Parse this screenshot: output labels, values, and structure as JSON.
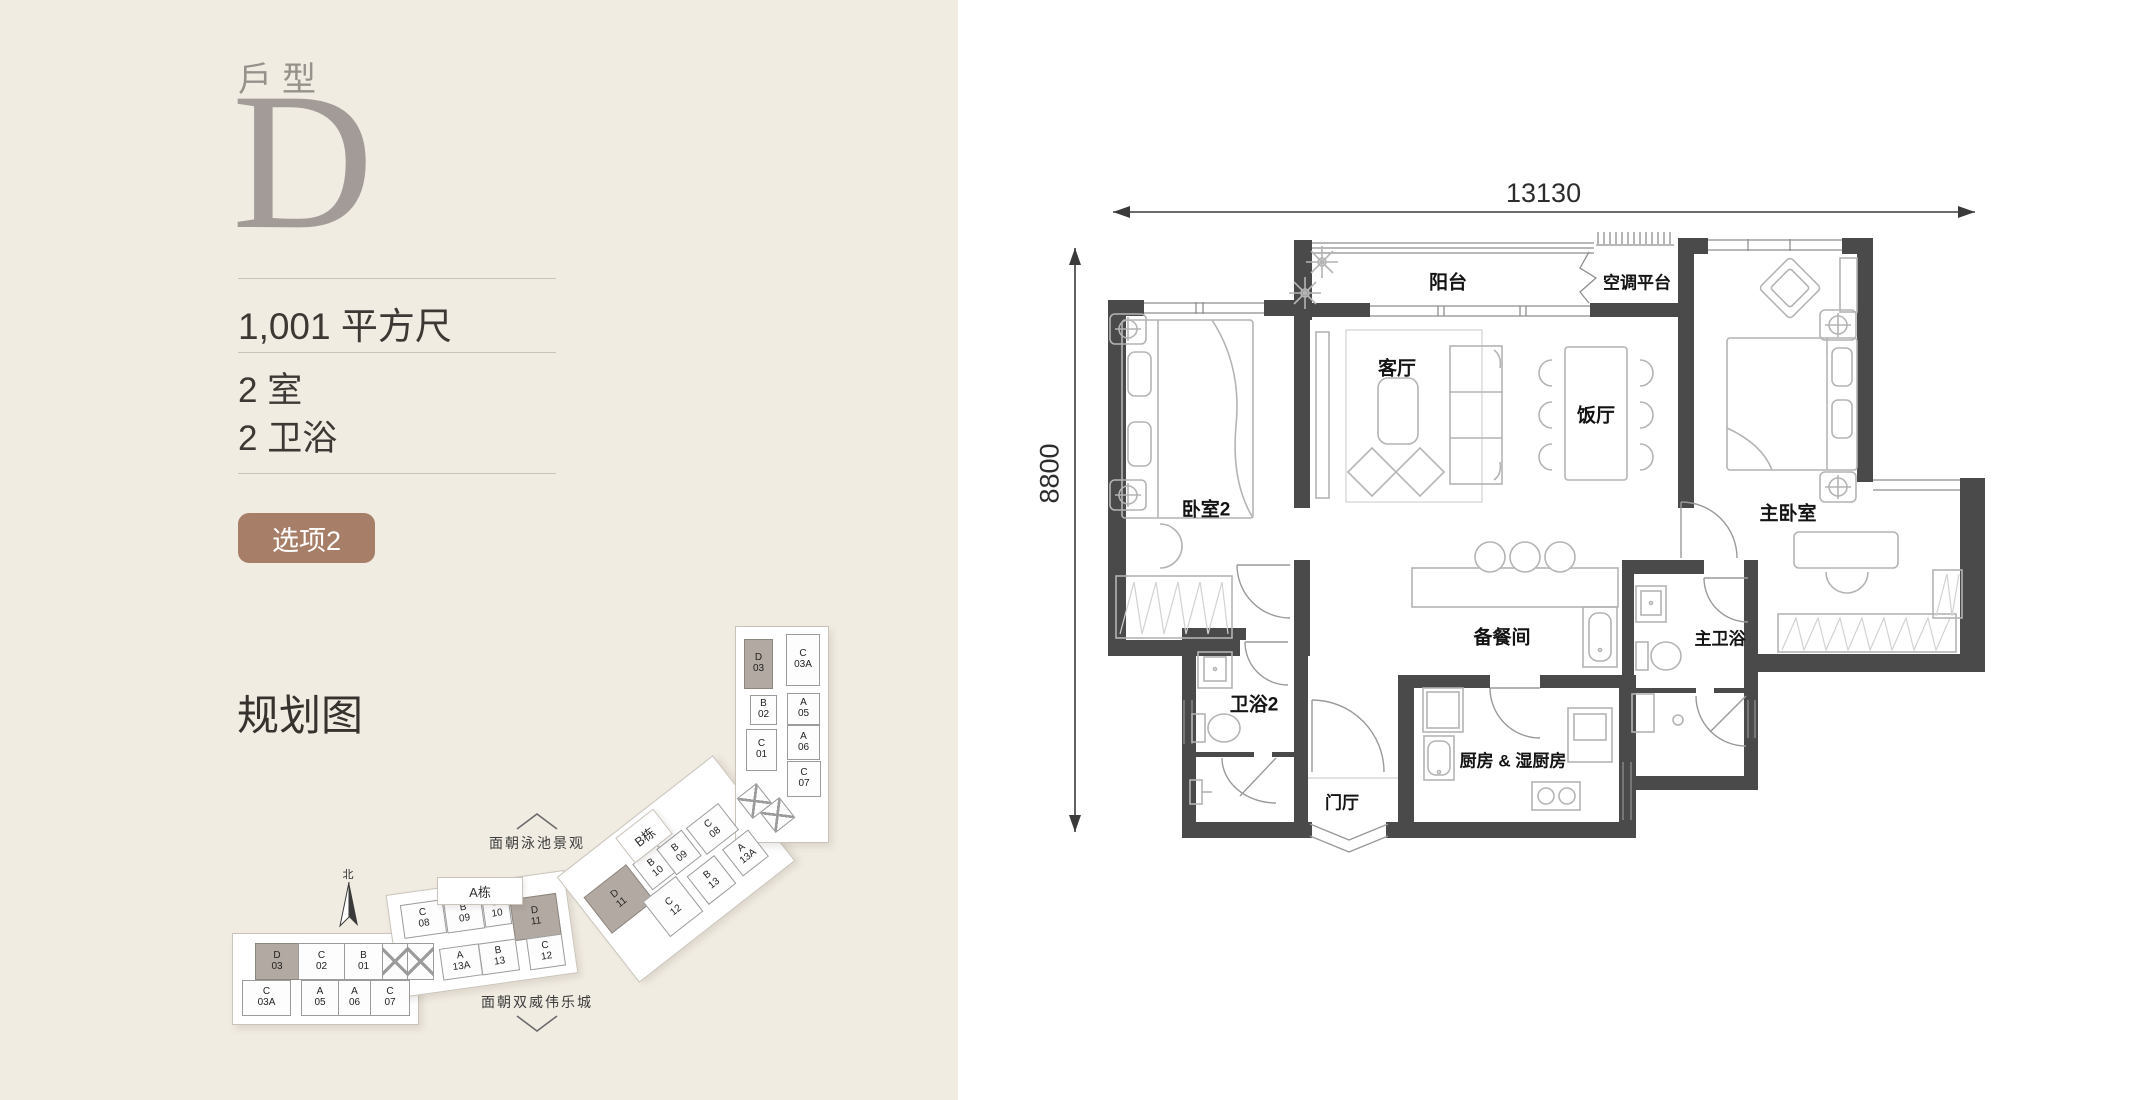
{
  "left_panel": {
    "unit_type_label": "戶型",
    "unit_type": "D",
    "area": "1,001 平方尺",
    "bedrooms": "2 室",
    "bathrooms": "2 卫浴",
    "option_badge": "选项2",
    "site_plan_title": "规划图"
  },
  "theme": {
    "panel_bg": "#f1ece2",
    "badge_bg": "#a77f68",
    "wall_color": "#4a4a4a",
    "unit_highlight": "#b2a9a2"
  },
  "site_plan": {
    "north_label": "北",
    "block_a_label": "A栋",
    "block_b_label": "B栋",
    "annotation_top": "面朝泳池景观",
    "annotation_bottom": "面朝双威伟乐城",
    "units": [
      {
        "l1": "D",
        "l2": "03",
        "x": 15,
        "y": 313,
        "w": 42,
        "h": 35,
        "hl": true
      },
      {
        "l1": "C",
        "l2": "02",
        "x": 58,
        "y": 313,
        "w": 45,
        "h": 35
      },
      {
        "l1": "B",
        "l2": "01",
        "x": 104,
        "y": 313,
        "w": 37,
        "h": 35
      },
      {
        "hatch": true,
        "x": 142,
        "y": 313,
        "w": 24,
        "h": 35
      },
      {
        "hatch": true,
        "x": 167,
        "y": 313,
        "w": 25,
        "h": 35
      },
      {
        "l1": "C",
        "l2": "03A",
        "x": 2,
        "y": 350,
        "w": 47,
        "h": 34
      },
      {
        "l1": "A",
        "l2": "05",
        "x": 61,
        "y": 350,
        "w": 36,
        "h": 34
      },
      {
        "l1": "A",
        "l2": "06",
        "x": 98,
        "y": 350,
        "w": 31,
        "h": 34
      },
      {
        "l1": "C",
        "l2": "07",
        "x": 130,
        "y": 350,
        "w": 38,
        "h": 34
      },
      {
        "l1": "C",
        "l2": "08",
        "x": 162,
        "y": 272,
        "w": 41,
        "h": 32,
        "rot": -8
      },
      {
        "l1": "B",
        "l2": "09",
        "x": 205,
        "y": 267,
        "w": 36,
        "h": 32,
        "rot": -8
      },
      {
        "l1": "B",
        "l2": "10",
        "x": 243,
        "y": 262,
        "w": 25,
        "h": 32,
        "rot": -8
      },
      {
        "l1": "D",
        "l2": "11",
        "x": 272,
        "y": 266,
        "w": 45,
        "h": 40,
        "rot": -8,
        "hl": true
      },
      {
        "l1": "A",
        "l2": "13A",
        "x": 201,
        "y": 316,
        "w": 38,
        "h": 30,
        "rot": -8
      },
      {
        "l1": "B",
        "l2": "13",
        "x": 240,
        "y": 311,
        "w": 36,
        "h": 30,
        "rot": -8
      },
      {
        "l1": "C",
        "l2": "12",
        "x": 288,
        "y": 306,
        "w": 34,
        "h": 30,
        "rot": -8
      },
      {
        "l1": "D",
        "l2": "11",
        "x": 352,
        "y": 246,
        "w": 52,
        "h": 44,
        "rot": -38,
        "hl": true
      },
      {
        "l1": "B",
        "l2": "10",
        "x": 399,
        "y": 221,
        "w": 30,
        "h": 31,
        "rot": -38
      },
      {
        "l1": "B",
        "l2": "09",
        "x": 423,
        "y": 206,
        "w": 30,
        "h": 31,
        "rot": -38
      },
      {
        "l1": "C",
        "l2": "08",
        "x": 452,
        "y": 182,
        "w": 39,
        "h": 32,
        "rot": -38
      },
      {
        "l1": "C",
        "l2": "12",
        "x": 412,
        "y": 254,
        "w": 40,
        "h": 43,
        "rot": -38
      },
      {
        "l1": "B",
        "l2": "13",
        "x": 454,
        "y": 232,
        "w": 33,
        "h": 34,
        "rot": -38
      },
      {
        "l1": "A",
        "l2": "13A",
        "x": 489,
        "y": 206,
        "w": 31,
        "h": 32,
        "rot": -38
      },
      {
        "hatch": true,
        "x": 502,
        "y": 158,
        "w": 23,
        "h": 24,
        "rot": -38
      },
      {
        "hatch": true,
        "x": 525,
        "y": 172,
        "w": 23,
        "h": 24,
        "rot": -38
      },
      {
        "l1": "D",
        "l2": "03",
        "x": 504,
        "y": 9,
        "w": 27,
        "h": 48,
        "hl": true
      },
      {
        "l1": "C",
        "l2": "03A",
        "x": 546,
        "y": 4,
        "w": 32,
        "h": 50
      },
      {
        "l1": "B",
        "l2": "02",
        "x": 510,
        "y": 65,
        "w": 25,
        "h": 28
      },
      {
        "l1": "A",
        "l2": "05",
        "x": 547,
        "y": 63,
        "w": 31,
        "h": 30
      },
      {
        "l1": "C",
        "l2": "01",
        "x": 506,
        "y": 99,
        "w": 29,
        "h": 40
      },
      {
        "l1": "A",
        "l2": "06",
        "x": 547,
        "y": 95,
        "w": 31,
        "h": 33
      },
      {
        "l1": "C",
        "l2": "07",
        "x": 547,
        "y": 131,
        "w": 32,
        "h": 34
      }
    ]
  },
  "floorplan": {
    "dim_width": "13130",
    "dim_height": "8800",
    "rooms": [
      {
        "key": "balcony",
        "label": "阳台"
      },
      {
        "key": "ac-platform",
        "label": "空调平台"
      },
      {
        "key": "living-room",
        "label": "客厅"
      },
      {
        "key": "dining-room",
        "label": "饭厅"
      },
      {
        "key": "bedroom-2",
        "label": "卧室2"
      },
      {
        "key": "master-bedroom",
        "label": "主卧室"
      },
      {
        "key": "pantry",
        "label": "备餐间"
      },
      {
        "key": "master-bath",
        "label": "主卫浴"
      },
      {
        "key": "bath-2",
        "label": "卫浴2"
      },
      {
        "key": "kitchen",
        "label": "厨房 & 湿厨房"
      },
      {
        "key": "foyer",
        "label": "门厅"
      }
    ]
  }
}
